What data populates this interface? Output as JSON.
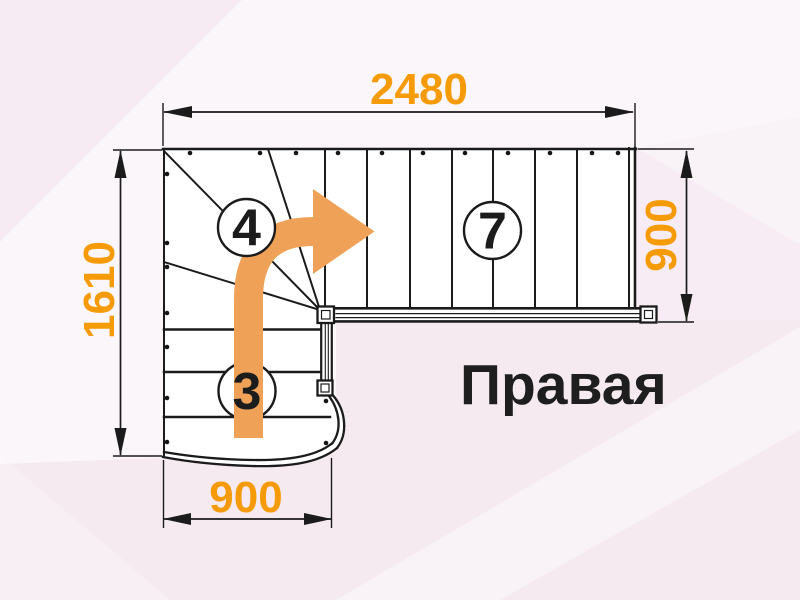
{
  "title": {
    "label": "Правая"
  },
  "dimensions": {
    "overall_length": "2480",
    "overall_depth": "1610",
    "upper_flight_width": "900",
    "lower_flight_width": "900"
  },
  "step_counts": {
    "upper_flight": "7",
    "winder_steps": "4",
    "lower_flight": "3"
  },
  "legend": {
    "drawing_type": "staircase-floor-plan",
    "turn_direction": "right-turn"
  },
  "colors": {
    "dimension_text": "#F59B07",
    "direction_arrow": "#EFA257",
    "line": "#1B1B1B",
    "background": "#FBF6FA",
    "background_accent": "#F6EAF1"
  }
}
